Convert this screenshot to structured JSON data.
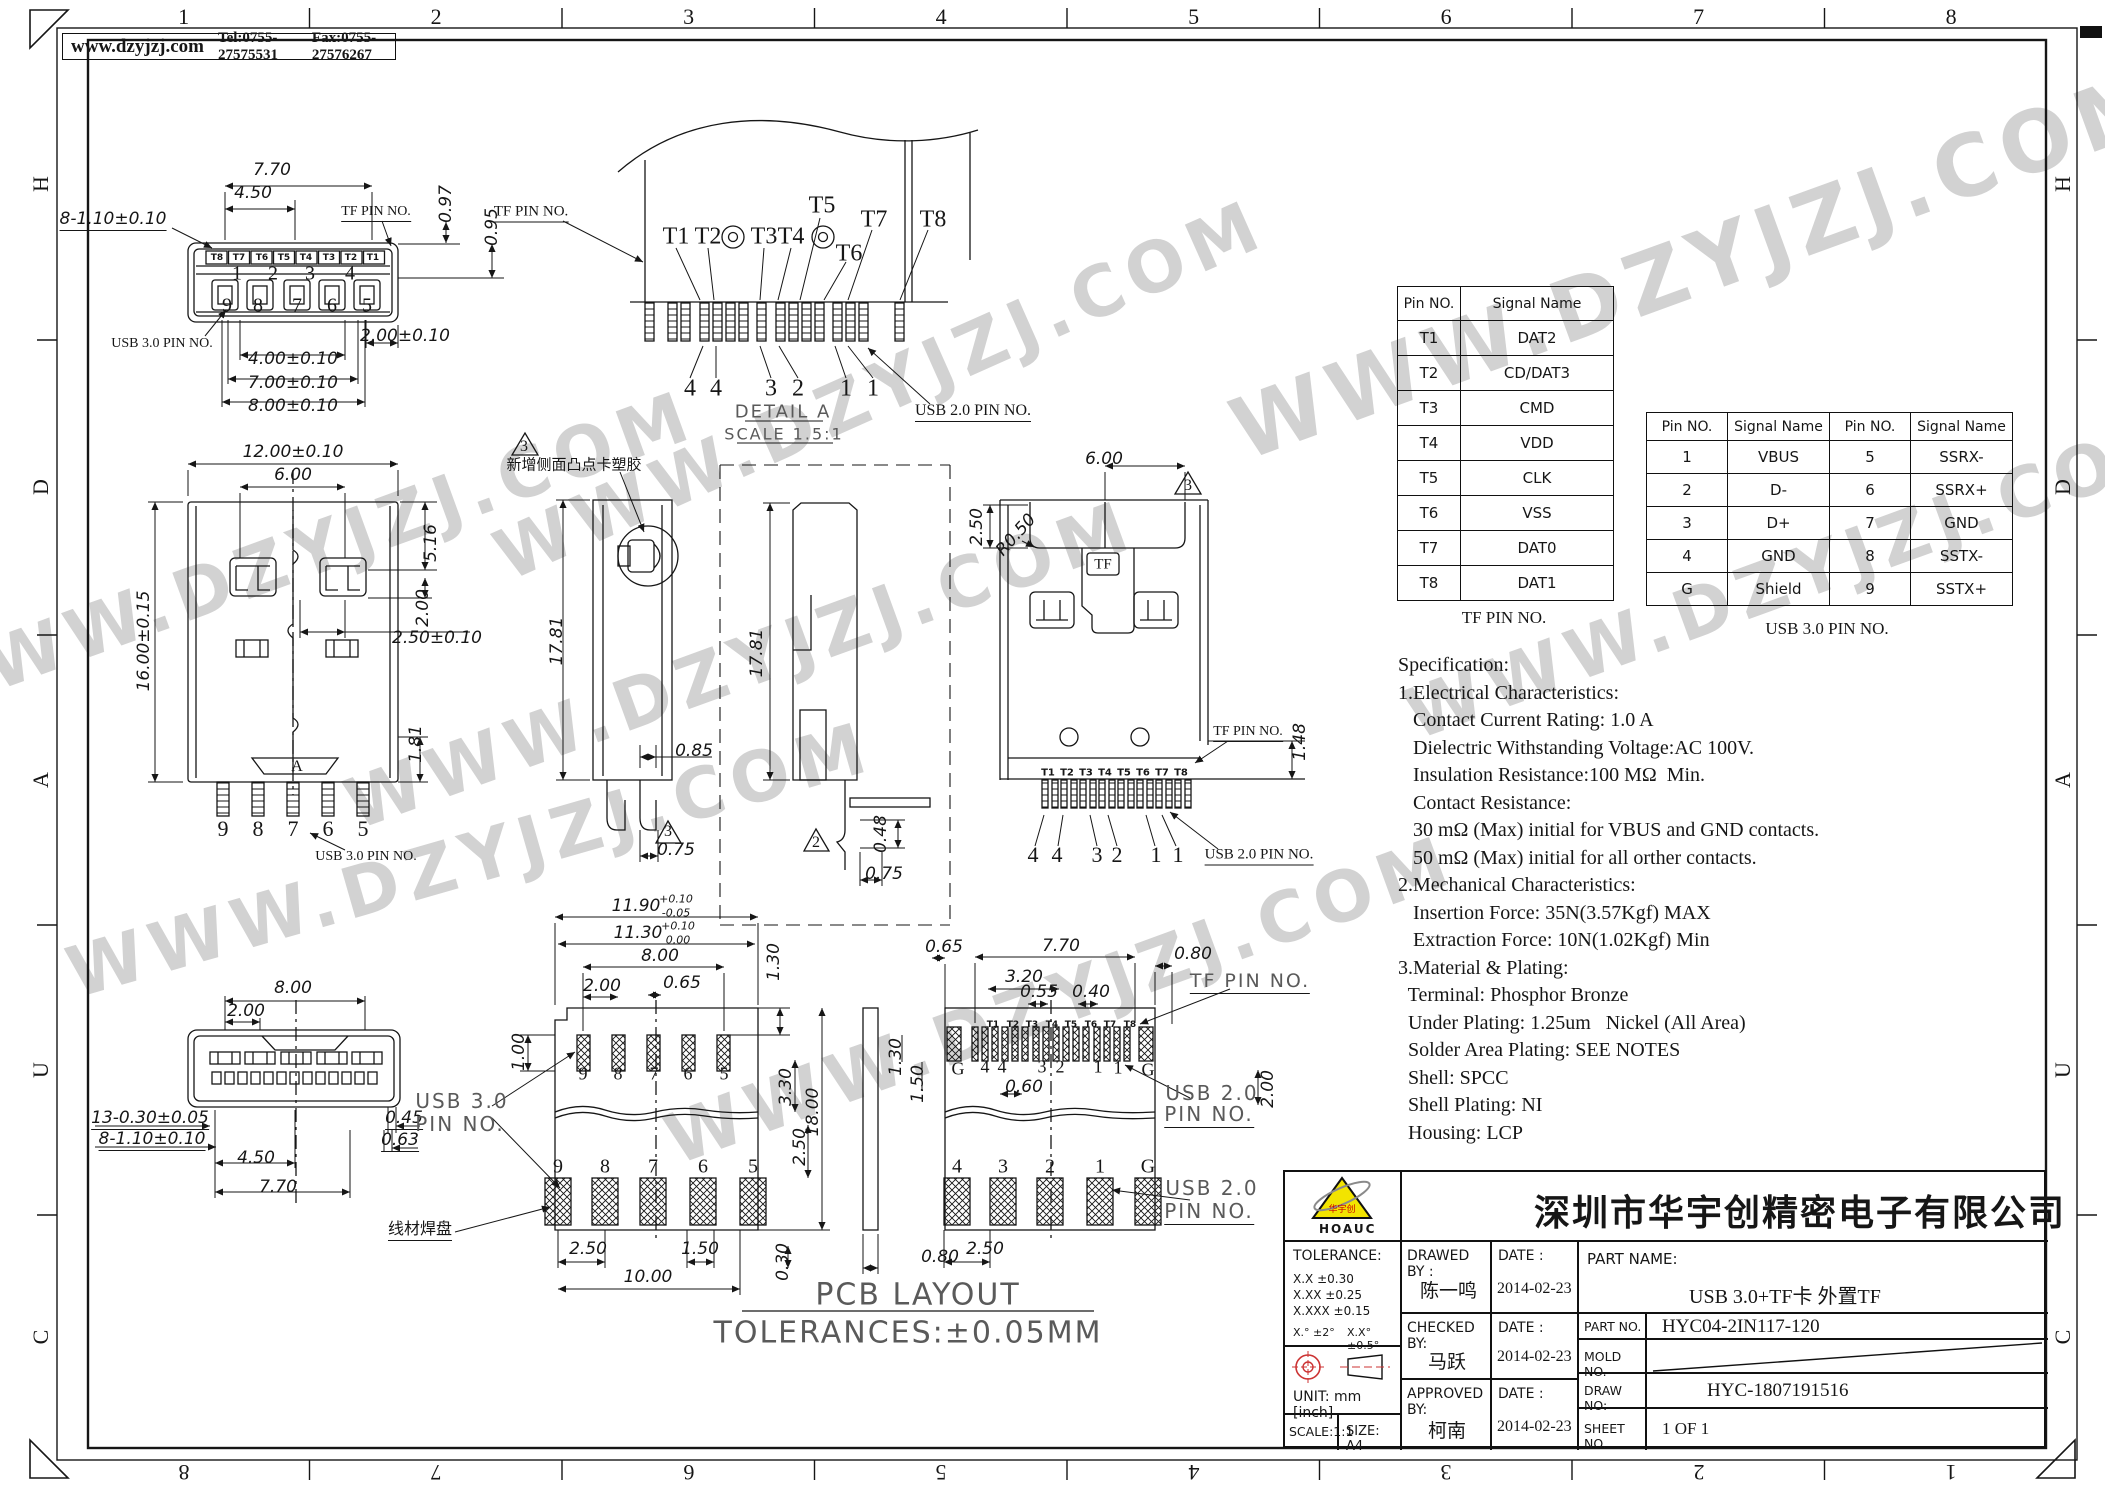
{
  "header": {
    "website": "www.dzyjzj.com",
    "tel": "Tel:0755-27575531",
    "fax": "Fax:0755-27576267"
  },
  "border": {
    "top": [
      "1",
      "2",
      "3",
      "4",
      "5",
      "6",
      "7",
      "8"
    ],
    "bottom": [
      "8",
      "7",
      "6",
      "5",
      "4",
      "3",
      "2",
      "1"
    ],
    "left": [
      "H",
      "D",
      "A",
      "U",
      "C"
    ],
    "right": [
      "H",
      "D",
      "A",
      "U",
      "C"
    ]
  },
  "tables": {
    "tf": {
      "caption": "TF PIN NO.",
      "headers": [
        "Pin NO.",
        "Signal Name"
      ],
      "rows": [
        [
          "T1",
          "DAT2"
        ],
        [
          "T2",
          "CD/DAT3"
        ],
        [
          "T3",
          "CMD"
        ],
        [
          "T4",
          "VDD"
        ],
        [
          "T5",
          "CLK"
        ],
        [
          "T6",
          "VSS"
        ],
        [
          "T7",
          "DAT0"
        ],
        [
          "T8",
          "DAT1"
        ]
      ]
    },
    "usb3": {
      "caption": "USB 3.0 PIN NO.",
      "headers": [
        "Pin NO.",
        "Signal Name",
        "Pin NO.",
        "Signal Name"
      ],
      "rows": [
        [
          "1",
          "VBUS",
          "5",
          "SSRX-"
        ],
        [
          "2",
          "D-",
          "6",
          "SSRX+"
        ],
        [
          "3",
          "D+",
          "7",
          "GND"
        ],
        [
          "4",
          "GND",
          "8",
          "SSTX-"
        ],
        [
          "G",
          "Shield",
          "9",
          "SSTX+"
        ]
      ]
    }
  },
  "specification": {
    "lines": [
      "Specification:",
      "1.Electrical Characteristics:",
      "   Contact Current Rating: 1.0 A",
      "   Dielectric Withstanding Voltage:AC 100V.",
      "   Insulation Resistance:100 MΩ  Min.",
      "   Contact Resistance:",
      "   30 mΩ (Max) initial for VBUS and GND contacts.",
      "   50 mΩ (Max) initial for all orther contacts.",
      "2.Mechanical Characteristics:",
      "   Insertion Force: 35N(3.57Kgf) MAX",
      "   Extraction Force: 10N(1.02Kgf) Min",
      "3.Material & Plating:",
      "  Terminal: Phosphor Bronze",
      "  Under Plating: 1.25um   Nickel (All Area)",
      "  Solder Area Plating: SEE NOTES",
      "  Shell: SPCC",
      "  Shell Plating: NI",
      "  Housing: LCP"
    ]
  },
  "title_block": {
    "company": "深圳市华宇创精密电子有限公司",
    "logo_text": "HOAUC",
    "logo_mark": "华宇创",
    "tolerance_title": "TOLERANCE:",
    "tol1": "X.X     ±0.30",
    "tol2": "X.XX   ±0.25",
    "tol3": "X.XXX ±0.15",
    "tol_deg1": "X.°  ±2°",
    "tol_deg2": "X.X°  ±0.5°",
    "unit_label": "UNIT:  mm  [inch]",
    "scale_label": "SCALE:1:1",
    "size_label": "SIZE:  A4",
    "drawed_by_label": "DRAWED  BY :",
    "drawed_by": "陈一鸣",
    "checked_by_label": "CHECKED  BY:",
    "checked_by": "马跃",
    "approved_by_label": "APPROVED  BY:",
    "approved_by": "柯南",
    "date_label": "DATE :",
    "date1": "2014-02-23",
    "date2": "2014-02-23",
    "date3": "2014-02-23",
    "part_name_label": "PART  NAME:",
    "part_name": "USB 3.0+TF卡  外置TF",
    "part_no_label": "PART  NO.",
    "part_no": "HYC04-2IN117-120",
    "mold_no_label": "MOLD  NO.",
    "draw_no_label": "DRAW  NO:",
    "draw_no": "HYC-1807191516",
    "sheet_no_label": "SHEET  NO.",
    "sheet_no": "1 OF 1"
  },
  "watermark": {
    "text": "WWW.DZYJZJ.COM",
    "positions": [
      {
        "x": 1700,
        "y": 265,
        "r": -20,
        "s": 85
      },
      {
        "x": 880,
        "y": 390,
        "r": -24,
        "s": 70
      },
      {
        "x": 300,
        "y": 555,
        "r": -20,
        "s": 70
      },
      {
        "x": 740,
        "y": 665,
        "r": -20,
        "s": 70
      },
      {
        "x": 1800,
        "y": 575,
        "r": -20,
        "s": 70
      },
      {
        "x": 470,
        "y": 860,
        "r": -16,
        "s": 70
      },
      {
        "x": 1060,
        "y": 1000,
        "r": -20,
        "s": 70
      }
    ]
  },
  "annotations": [
    {
      "t": "7.70",
      "x": 272,
      "y": 170
    },
    {
      "t": "4.50",
      "x": 253,
      "y": 193
    },
    {
      "t": "8-1.10±0.10",
      "x": 113,
      "y": 220,
      "u": 1
    },
    {
      "t": "TF PIN NO.",
      "x": 376,
      "y": 213,
      "f": "l",
      "s": 14,
      "u": 1
    },
    {
      "t": "0.97",
      "x": 446,
      "y": 204,
      "r": -90
    },
    {
      "t": "0.95",
      "x": 492,
      "y": 227,
      "r": -90
    },
    {
      "t": "T8",
      "x": 217,
      "y": 258,
      "f": "t",
      "s": 9
    },
    {
      "t": "T7",
      "x": 239,
      "y": 258,
      "f": "t",
      "s": 9
    },
    {
      "t": "T6",
      "x": 262,
      "y": 258,
      "f": "t",
      "s": 9
    },
    {
      "t": "T5",
      "x": 284,
      "y": 258,
      "f": "t",
      "s": 9
    },
    {
      "t": "T4",
      "x": 306,
      "y": 258,
      "f": "t",
      "s": 9
    },
    {
      "t": "T3",
      "x": 329,
      "y": 258,
      "f": "t",
      "s": 9
    },
    {
      "t": "T2",
      "x": 351,
      "y": 258,
      "f": "t",
      "s": 9
    },
    {
      "t": "T1",
      "x": 373,
      "y": 258,
      "f": "t",
      "s": 9
    },
    {
      "t": "1",
      "x": 237,
      "y": 274,
      "f": "n",
      "s": 20
    },
    {
      "t": "2",
      "x": 273,
      "y": 274,
      "f": "n",
      "s": 20
    },
    {
      "t": "3",
      "x": 310,
      "y": 274,
      "f": "n",
      "s": 20
    },
    {
      "t": "4",
      "x": 350,
      "y": 274,
      "f": "n",
      "s": 20
    },
    {
      "t": "9",
      "x": 227,
      "y": 306,
      "f": "n",
      "s": 20
    },
    {
      "t": "8",
      "x": 258,
      "y": 306,
      "f": "n",
      "s": 20
    },
    {
      "t": "7",
      "x": 297,
      "y": 306,
      "f": "n",
      "s": 20
    },
    {
      "t": "6",
      "x": 332,
      "y": 306,
      "f": "n",
      "s": 20
    },
    {
      "t": "5",
      "x": 367,
      "y": 306,
      "f": "n",
      "s": 20
    },
    {
      "t": "USB 3.0 PIN NO.",
      "x": 162,
      "y": 344,
      "f": "l",
      "s": 14
    },
    {
      "t": "2.00±0.10",
      "x": 405,
      "y": 336
    },
    {
      "t": "4.00±0.10",
      "x": 293,
      "y": 359
    },
    {
      "t": "7.00±0.10",
      "x": 293,
      "y": 383
    },
    {
      "t": "8.00±0.10",
      "x": 293,
      "y": 406
    },
    {
      "t": "TF PIN NO.",
      "x": 531,
      "y": 213,
      "f": "l",
      "s": 15,
      "u": 1
    },
    {
      "t": "T1",
      "x": 676,
      "y": 237,
      "f": "n",
      "s": 24
    },
    {
      "t": "T2",
      "x": 708,
      "y": 237,
      "f": "n",
      "s": 24
    },
    {
      "t": "T3",
      "x": 764,
      "y": 237,
      "f": "n",
      "s": 24
    },
    {
      "t": "T4",
      "x": 791,
      "y": 237,
      "f": "n",
      "s": 24
    },
    {
      "t": "T5",
      "x": 822,
      "y": 206,
      "f": "n",
      "s": 24
    },
    {
      "t": "T6",
      "x": 849,
      "y": 254,
      "f": "n",
      "s": 24
    },
    {
      "t": "T7",
      "x": 874,
      "y": 220,
      "f": "n",
      "s": 24
    },
    {
      "t": "T8",
      "x": 933,
      "y": 220,
      "f": "n",
      "s": 24
    },
    {
      "t": "4",
      "x": 690,
      "y": 389,
      "f": "n",
      "s": 24
    },
    {
      "t": "4",
      "x": 716,
      "y": 389,
      "f": "n",
      "s": 24
    },
    {
      "t": "3",
      "x": 771,
      "y": 389,
      "f": "n",
      "s": 24
    },
    {
      "t": "2",
      "x": 798,
      "y": 389,
      "f": "n",
      "s": 24
    },
    {
      "t": "1",
      "x": 846,
      "y": 389,
      "f": "n",
      "s": 24
    },
    {
      "t": "1",
      "x": 873,
      "y": 389,
      "f": "n",
      "s": 24
    },
    {
      "t": "DETAIL A",
      "x": 783,
      "y": 412,
      "f": "g",
      "s": 18
    },
    {
      "t": "SCALE 1.5:1",
      "x": 784,
      "y": 434,
      "f": "g",
      "s": 16
    },
    {
      "t": "USB 2.0 PIN NO.",
      "x": 973,
      "y": 412,
      "f": "l",
      "s": 16,
      "u": 1
    },
    {
      "t": "12.00±0.10",
      "x": 293,
      "y": 452
    },
    {
      "t": "6.00",
      "x": 293,
      "y": 475
    },
    {
      "t": "16.00±0.15",
      "x": 144,
      "y": 641,
      "r": -90
    },
    {
      "t": "5.16",
      "x": 431,
      "y": 543,
      "r": -90
    },
    {
      "t": "2.00",
      "x": 423,
      "y": 608,
      "r": -90
    },
    {
      "t": "2.50±0.10",
      "x": 437,
      "y": 638
    },
    {
      "t": "1.81",
      "x": 416,
      "y": 744,
      "r": -90
    },
    {
      "t": "9",
      "x": 223,
      "y": 829,
      "f": "n",
      "s": 22
    },
    {
      "t": "8",
      "x": 258,
      "y": 829,
      "f": "n",
      "s": 22
    },
    {
      "t": "7",
      "x": 293,
      "y": 829,
      "f": "n",
      "s": 22
    },
    {
      "t": "6",
      "x": 328,
      "y": 829,
      "f": "n",
      "s": 22
    },
    {
      "t": "5",
      "x": 363,
      "y": 829,
      "f": "n",
      "s": 22
    },
    {
      "t": "USB 3.0 PIN NO.",
      "x": 366,
      "y": 857,
      "f": "l",
      "s": 14
    },
    {
      "t": "A",
      "x": 297,
      "y": 767,
      "f": "n",
      "s": 16
    },
    {
      "t": "3",
      "x": 524,
      "y": 447,
      "f": "n",
      "s": 16
    },
    {
      "t": "新增侧面凸点卡塑胶",
      "x": 574,
      "y": 464,
      "f": "c",
      "s": 15
    },
    {
      "t": "17.81",
      "x": 557,
      "y": 641,
      "r": -90
    },
    {
      "t": "0.85",
      "x": 694,
      "y": 751
    },
    {
      "t": "3",
      "x": 668,
      "y": 832,
      "f": "n",
      "s": 16
    },
    {
      "t": "0.75",
      "x": 676,
      "y": 850
    },
    {
      "t": "17.81",
      "x": 757,
      "y": 653,
      "r": -90
    },
    {
      "t": "2",
      "x": 816,
      "y": 843,
      "f": "n",
      "s": 16
    },
    {
      "t": "0.48",
      "x": 881,
      "y": 834,
      "r": -90
    },
    {
      "t": "0.75",
      "x": 884,
      "y": 874
    },
    {
      "t": "6.00",
      "x": 1104,
      "y": 459
    },
    {
      "t": "3",
      "x": 1188,
      "y": 486,
      "f": "n",
      "s": 16
    },
    {
      "t": "2.50",
      "x": 977,
      "y": 527,
      "r": -90
    },
    {
      "t": "R0.50",
      "x": 1016,
      "y": 535,
      "r": -48
    },
    {
      "t": "TF",
      "x": 1103,
      "y": 565,
      "f": "n",
      "s": 15
    },
    {
      "t": "T1",
      "x": 1048,
      "y": 773,
      "f": "t",
      "s": 10
    },
    {
      "t": "T2",
      "x": 1067,
      "y": 773,
      "f": "t",
      "s": 10
    },
    {
      "t": "T3",
      "x": 1086,
      "y": 773,
      "f": "t",
      "s": 10
    },
    {
      "t": "T4",
      "x": 1105,
      "y": 773,
      "f": "t",
      "s": 10
    },
    {
      "t": "T5",
      "x": 1124,
      "y": 773,
      "f": "t",
      "s": 10
    },
    {
      "t": "T6",
      "x": 1143,
      "y": 773,
      "f": "t",
      "s": 10
    },
    {
      "t": "T7",
      "x": 1162,
      "y": 773,
      "f": "t",
      "s": 10
    },
    {
      "t": "T8",
      "x": 1181,
      "y": 773,
      "f": "t",
      "s": 10
    },
    {
      "t": "TF PIN NO.",
      "x": 1248,
      "y": 733,
      "f": "l",
      "s": 14,
      "u": 1
    },
    {
      "t": "1.48",
      "x": 1300,
      "y": 742,
      "r": -90
    },
    {
      "t": "4",
      "x": 1033,
      "y": 855,
      "f": "n",
      "s": 22
    },
    {
      "t": "4",
      "x": 1057,
      "y": 855,
      "f": "n",
      "s": 22
    },
    {
      "t": "3",
      "x": 1097,
      "y": 855,
      "f": "n",
      "s": 22
    },
    {
      "t": "2",
      "x": 1117,
      "y": 855,
      "f": "n",
      "s": 22
    },
    {
      "t": "1",
      "x": 1156,
      "y": 855,
      "f": "n",
      "s": 22
    },
    {
      "t": "1",
      "x": 1178,
      "y": 855,
      "f": "n",
      "s": 22
    },
    {
      "t": "USB 2.0 PIN NO.",
      "x": 1259,
      "y": 856,
      "f": "l",
      "s": 15,
      "u": 1
    },
    {
      "t": "8.00",
      "x": 293,
      "y": 988
    },
    {
      "t": "2.00",
      "x": 246,
      "y": 1011
    },
    {
      "t": "13-0.30±0.05",
      "x": 150,
      "y": 1119,
      "u": 1
    },
    {
      "t": "8-1.10±0.10",
      "x": 152,
      "y": 1140,
      "u": 1
    },
    {
      "t": "0.45",
      "x": 404,
      "y": 1119,
      "u": 1
    },
    {
      "t": "0.63",
      "x": 400,
      "y": 1141,
      "u": 1
    },
    {
      "t": "4.50",
      "x": 256,
      "y": 1158
    },
    {
      "t": "7.70",
      "x": 278,
      "y": 1187
    },
    {
      "t": "11.90",
      "x": 636,
      "y": 906
    },
    {
      "t": "+0.10",
      "x": 676,
      "y": 899,
      "s": 11
    },
    {
      "t": "-0.05",
      "x": 676,
      "y": 913,
      "s": 11
    },
    {
      "t": "11.30",
      "x": 638,
      "y": 933
    },
    {
      "t": "+0.10",
      "x": 678,
      "y": 926,
      "s": 11
    },
    {
      "t": "0.00",
      "x": 678,
      "y": 940,
      "s": 11
    },
    {
      "t": "8.00",
      "x": 660,
      "y": 956
    },
    {
      "t": "2.00",
      "x": 602,
      "y": 986
    },
    {
      "t": "0.65",
      "x": 682,
      "y": 983
    },
    {
      "t": "1.30",
      "x": 774,
      "y": 962,
      "r": -90
    },
    {
      "t": "1.00",
      "x": 519,
      "y": 1052,
      "r": -90
    },
    {
      "t": "9",
      "x": 583,
      "y": 1074,
      "f": "n",
      "s": 18
    },
    {
      "t": "8",
      "x": 618,
      "y": 1074,
      "f": "n",
      "s": 18
    },
    {
      "t": "7",
      "x": 654,
      "y": 1074,
      "f": "n",
      "s": 18
    },
    {
      "t": "6",
      "x": 688,
      "y": 1074,
      "f": "n",
      "s": 18
    },
    {
      "t": "5",
      "x": 724,
      "y": 1074,
      "f": "n",
      "s": 18
    },
    {
      "t": "3.30",
      "x": 786,
      "y": 1087,
      "r": -90
    },
    {
      "t": "18.00",
      "x": 813,
      "y": 1112,
      "r": -90
    },
    {
      "t": "2.50",
      "x": 800,
      "y": 1147,
      "r": -90
    },
    {
      "t": "9",
      "x": 558,
      "y": 1167,
      "f": "n",
      "s": 20
    },
    {
      "t": "8",
      "x": 605,
      "y": 1167,
      "f": "n",
      "s": 20
    },
    {
      "t": "7",
      "x": 653,
      "y": 1167,
      "f": "n",
      "s": 20
    },
    {
      "t": "6",
      "x": 703,
      "y": 1167,
      "f": "n",
      "s": 20
    },
    {
      "t": "5",
      "x": 753,
      "y": 1167,
      "f": "n",
      "s": 20
    },
    {
      "t": "2.50",
      "x": 588,
      "y": 1249
    },
    {
      "t": "1.50",
      "x": 700,
      "y": 1249
    },
    {
      "t": "0.30",
      "x": 783,
      "y": 1262,
      "r": -90
    },
    {
      "t": "10.00",
      "x": 648,
      "y": 1277
    },
    {
      "t": "1.30",
      "x": 896,
      "y": 1057,
      "r": -90
    },
    {
      "t": "1.50",
      "x": 918,
      "y": 1084,
      "r": -90
    },
    {
      "t": "0.80",
      "x": 940,
      "y": 1257
    },
    {
      "t": "0.65",
      "x": 944,
      "y": 947
    },
    {
      "t": "7.70",
      "x": 1061,
      "y": 946
    },
    {
      "t": "3.20",
      "x": 1024,
      "y": 977
    },
    {
      "t": "0.55",
      "x": 1039,
      "y": 992
    },
    {
      "t": "0.40",
      "x": 1091,
      "y": 992
    },
    {
      "t": "0.80",
      "x": 1193,
      "y": 954
    },
    {
      "t": "TF PIN NO.",
      "x": 1250,
      "y": 982,
      "f": "g",
      "s": 19,
      "u": 1
    },
    {
      "t": "T1",
      "x": 993,
      "y": 1025,
      "f": "t",
      "s": 9
    },
    {
      "t": "T2",
      "x": 1013,
      "y": 1025,
      "f": "t",
      "s": 9
    },
    {
      "t": "T3",
      "x": 1032,
      "y": 1025,
      "f": "t",
      "s": 9
    },
    {
      "t": "T4",
      "x": 1052,
      "y": 1025,
      "f": "t",
      "s": 9
    },
    {
      "t": "T5",
      "x": 1071,
      "y": 1025,
      "f": "t",
      "s": 9
    },
    {
      "t": "T6",
      "x": 1091,
      "y": 1025,
      "f": "t",
      "s": 9
    },
    {
      "t": "T7",
      "x": 1110,
      "y": 1025,
      "f": "t",
      "s": 9
    },
    {
      "t": "T8",
      "x": 1130,
      "y": 1025,
      "f": "t",
      "s": 9
    },
    {
      "t": "G",
      "x": 958,
      "y": 1069,
      "f": "n",
      "s": 18
    },
    {
      "t": "4",
      "x": 985,
      "y": 1067,
      "f": "n",
      "s": 18
    },
    {
      "t": "4",
      "x": 1002,
      "y": 1067,
      "f": "n",
      "s": 18
    },
    {
      "t": "3",
      "x": 1042,
      "y": 1067,
      "f": "n",
      "s": 18
    },
    {
      "t": "2",
      "x": 1060,
      "y": 1067,
      "f": "n",
      "s": 18
    },
    {
      "t": "1",
      "x": 1098,
      "y": 1067,
      "f": "n",
      "s": 18
    },
    {
      "t": "1",
      "x": 1118,
      "y": 1068,
      "f": "n",
      "s": 18
    },
    {
      "t": "G",
      "x": 1148,
      "y": 1070,
      "f": "n",
      "s": 18
    },
    {
      "t": "0.60",
      "x": 1024,
      "y": 1087
    },
    {
      "t": "2.00",
      "x": 1268,
      "y": 1089,
      "r": -90
    },
    {
      "t": "USB 2.0",
      "x": 1212,
      "y": 1093,
      "f": "g",
      "s": 20
    },
    {
      "t": "PIN NO.",
      "x": 1209,
      "y": 1115,
      "f": "g",
      "s": 20,
      "u": 1
    },
    {
      "t": "4",
      "x": 957,
      "y": 1167,
      "f": "n",
      "s": 20
    },
    {
      "t": "3",
      "x": 1003,
      "y": 1167,
      "f": "n",
      "s": 20
    },
    {
      "t": "2",
      "x": 1050,
      "y": 1167,
      "f": "n",
      "s": 20
    },
    {
      "t": "1",
      "x": 1100,
      "y": 1167,
      "f": "n",
      "s": 20
    },
    {
      "t": "G",
      "x": 1148,
      "y": 1167,
      "f": "n",
      "s": 20
    },
    {
      "t": "USB 2.0",
      "x": 1212,
      "y": 1188,
      "f": "g",
      "s": 20
    },
    {
      "t": "PIN NO.",
      "x": 1209,
      "y": 1212,
      "f": "g",
      "s": 20,
      "u": 1
    },
    {
      "t": "2.50",
      "x": 985,
      "y": 1249
    },
    {
      "t": "USB 3.0",
      "x": 462,
      "y": 1101,
      "f": "g",
      "s": 20
    },
    {
      "t": "PIN NO.",
      "x": 460,
      "y": 1124,
      "f": "g",
      "s": 20
    },
    {
      "t": "线材焊盘",
      "x": 420,
      "y": 1228,
      "f": "c",
      "s": 16,
      "u": 1
    },
    {
      "t": "PCB LAYOUT",
      "x": 918,
      "y": 1295,
      "f": "g",
      "s": 30
    },
    {
      "t": "TOLERANCES:±0.05MM",
      "x": 908,
      "y": 1333,
      "f": "g",
      "s": 30
    }
  ]
}
